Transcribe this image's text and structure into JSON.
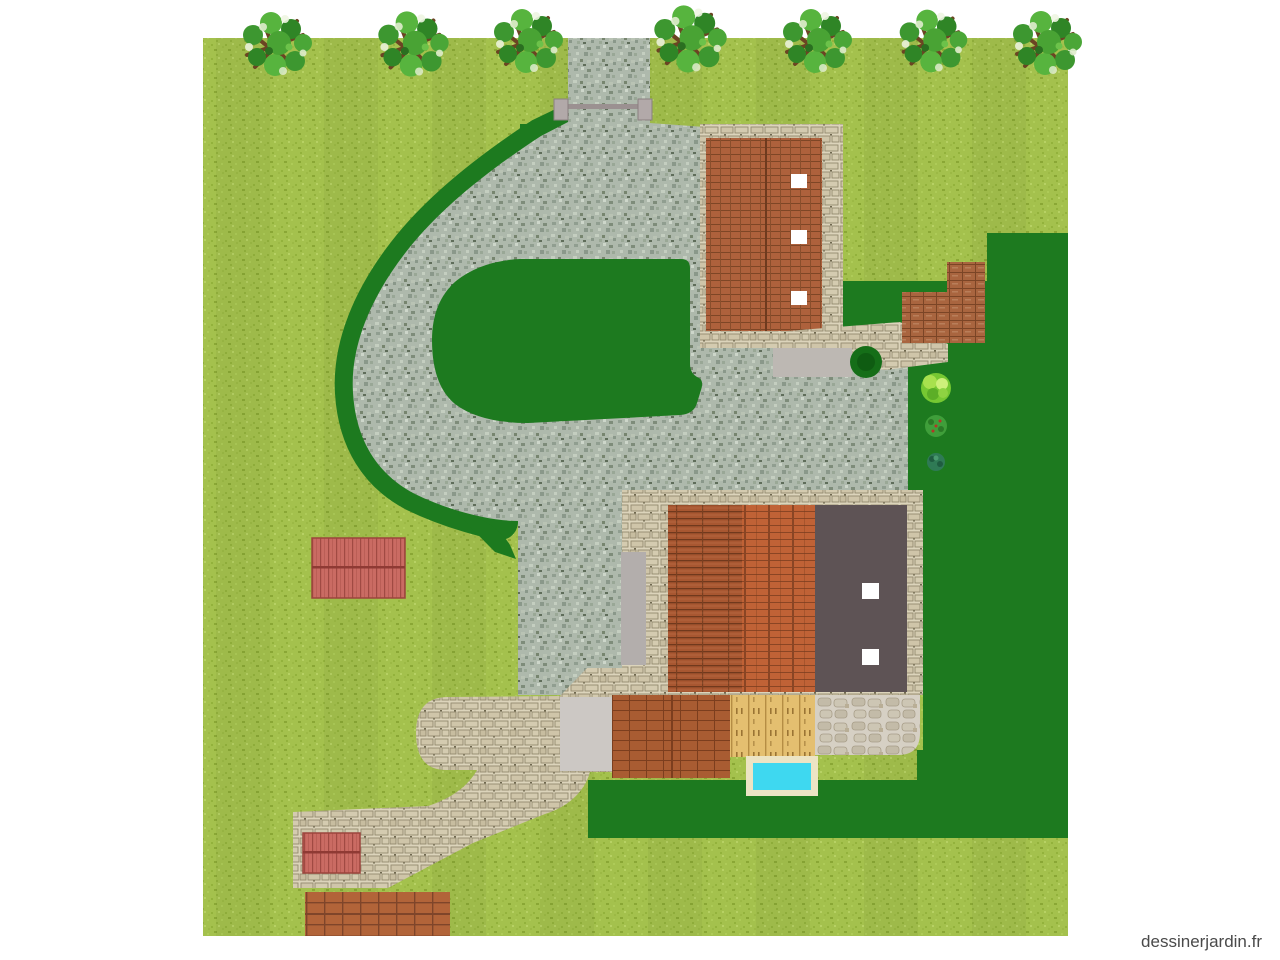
{
  "watermark": {
    "label": "dessinerjardin.fr"
  },
  "plan": {
    "description": "garden-landscape-plan",
    "trees_along_top": 7,
    "structures": [
      "garage-top-right",
      "main-house",
      "red-shed-left",
      "red-shed-bottom-left"
    ],
    "water_features": [
      "swimming-pool"
    ],
    "surfaces": [
      "gravel-driveway-loop",
      "stone-forecourt-path",
      "wood-deck",
      "patio-terrace",
      "cobble-terrace",
      "brick-steps",
      "terrace-paving-bottom"
    ],
    "planting": [
      "light-lawn",
      "dark-lawn",
      "driveway-island",
      "hedge-border",
      "round-tree",
      "bright-bush",
      "berry-bush",
      "small-dark-bush"
    ]
  },
  "colors": {
    "grassLight": "#a4c14d",
    "grassDark": "#1d7a1f",
    "islandGreen": "#1d7a1f",
    "hedge": "#1d7a1f",
    "gravelBase": "#aeb9ac",
    "stoneBase": "#dcd4bb",
    "stoneBlock": "#cfc5a9",
    "cobbleBase": "#d6d0c4",
    "roofGarage": "#ae613c",
    "roofHouseLeft": "#a85731",
    "roofHouseMid": "#c06236",
    "roofFlat": "#5e5355",
    "skylight": "#ffffff",
    "stepsBrick": "#a9653f",
    "patio": "#a95c32",
    "paving": "#b26439",
    "deck": "#e4bf70",
    "redShed": "#ca6b63",
    "poolWater": "#3ed8f0",
    "poolBorder": "#ece4c4",
    "concretePad": "#bdb8b3",
    "concreteStrip": "#b3aeac",
    "forecourtPad": "#ccc8c4",
    "gatePost": "#b2a9a9",
    "gateBar": "#9b9191",
    "treeBranch": "#6b4423",
    "treeFoliage": "#49a334",
    "roundTree": "#156e18",
    "bushBright": "#76c832",
    "bushBerry": "#3f9e3a",
    "bushSmall": "#2f7a55",
    "watermark": "#4a4a4a"
  }
}
